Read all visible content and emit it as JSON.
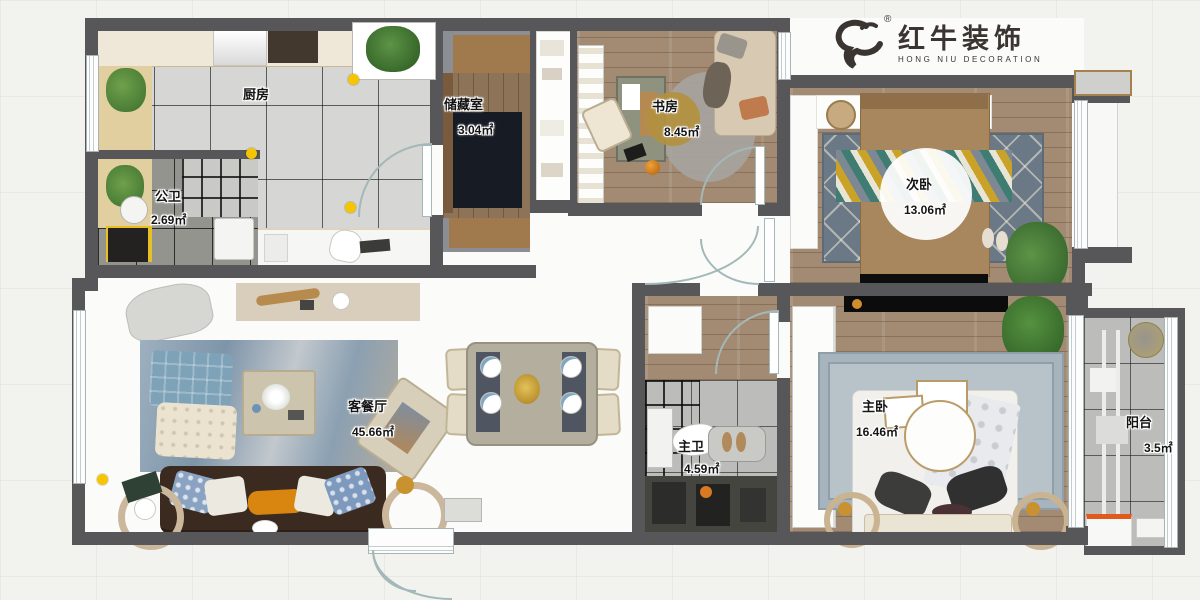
{
  "brand": {
    "name": "红牛装饰",
    "sub": "HONG NIU DECORATION",
    "registered": "®"
  },
  "rooms": {
    "kitchen": {
      "name": "厨房"
    },
    "storage": {
      "name": "储藏室",
      "area": "3.04㎡"
    },
    "study": {
      "name": "书房",
      "area": "8.45㎡"
    },
    "secondary_bedroom": {
      "name": "次卧",
      "area": "13.06㎡"
    },
    "public_bath": {
      "name": "公卫",
      "area": "2.69㎡"
    },
    "living_dining": {
      "name": "客餐厅",
      "area": "45.66㎡"
    },
    "master_bath": {
      "name": "主卫",
      "area": "4.59㎡"
    },
    "master_bedroom": {
      "name": "主卧",
      "area": "16.46㎡"
    },
    "balcony": {
      "name": "阳台",
      "area": "3.5㎡"
    }
  },
  "colors": {
    "wall": "#57575a",
    "accent_dot": "#f5c500",
    "wood_floor": "#a28a73",
    "tile_light": "#d6d6d4",
    "tile_dark": "#94948f",
    "rug_blue": "#8da2b4",
    "sofa_brown": "#3a2a20"
  }
}
